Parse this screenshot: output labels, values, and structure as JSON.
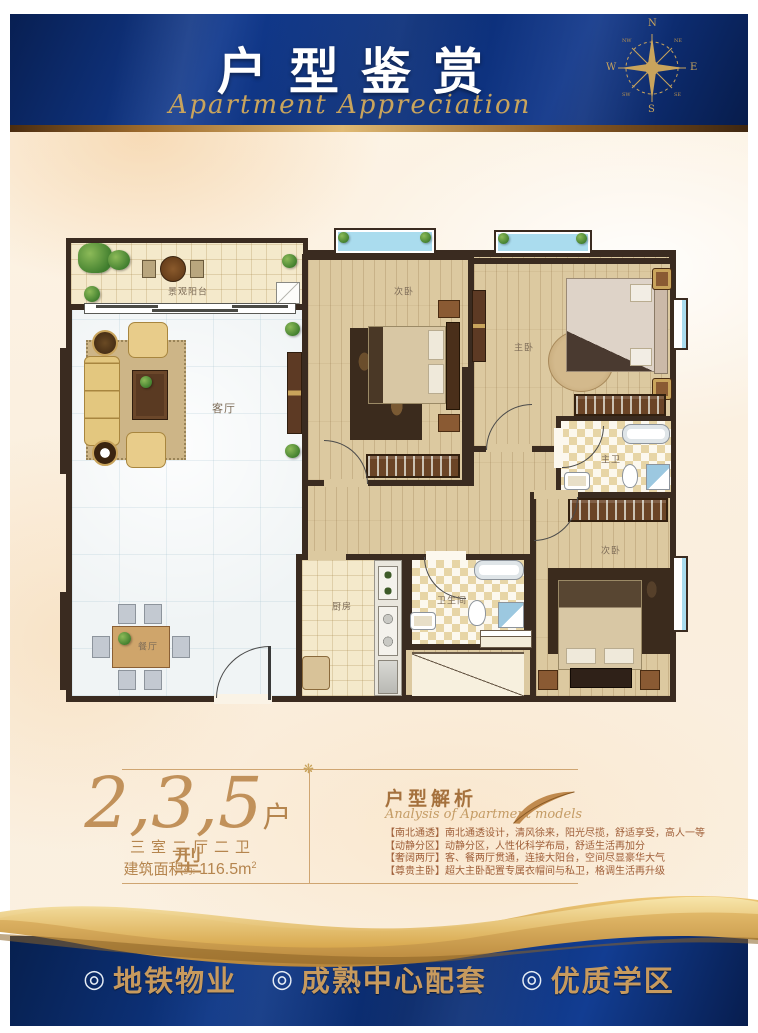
{
  "header": {
    "title": "户型鉴赏",
    "subtitle": "Apartment Appreciation",
    "compass": {
      "n": "N",
      "e": "E",
      "s": "S",
      "w": "W",
      "nw": "NW",
      "ne": "NE",
      "sw": "SW",
      "se": "SE"
    }
  },
  "plan": {
    "rooms": {
      "balcony": "景观阳台",
      "living": "客厅",
      "dining": "餐厅",
      "kitchen": "厨房",
      "bathroom": "卫生间",
      "bedroom_top": "次卧",
      "master_bedroom": "主卧",
      "master_bath": "主卫",
      "bedroom_right": "次卧"
    }
  },
  "info": {
    "model_number": "2,3,5",
    "model_suffix": "户型",
    "layout_spec": "三室二厅二卫",
    "area_label": "建筑面积",
    "area_approx": "约:",
    "area_value": "116.5m",
    "area_sup": "2",
    "divider_ornament": "❋",
    "analysis_title": "户型解析",
    "analysis_subtitle": "Analysis of Apartment models",
    "bullets": [
      "【南北通透】南北通透设计，清风徐来，阳光尽揽，舒适享受，高人一等",
      "【动静分区】动静分区，人性化科学布局，舒适生活再加分",
      "【奢阔两厅】客、餐两厅贯通，连接大阳台，空间尽显豪华大气",
      "【尊贵主卧】超大主卧配置专属衣帽间与私卫，格调生活再升级"
    ]
  },
  "footer": {
    "bullet": "◎",
    "items": [
      "地铁物业",
      "成熟中心配套",
      "优质学区"
    ]
  },
  "colors": {
    "navy": "#0c2e72",
    "gold": "#c9a45c",
    "wall": "#3a2b20",
    "window_blue": "#aadcee",
    "text_brown": "#a5703f"
  }
}
